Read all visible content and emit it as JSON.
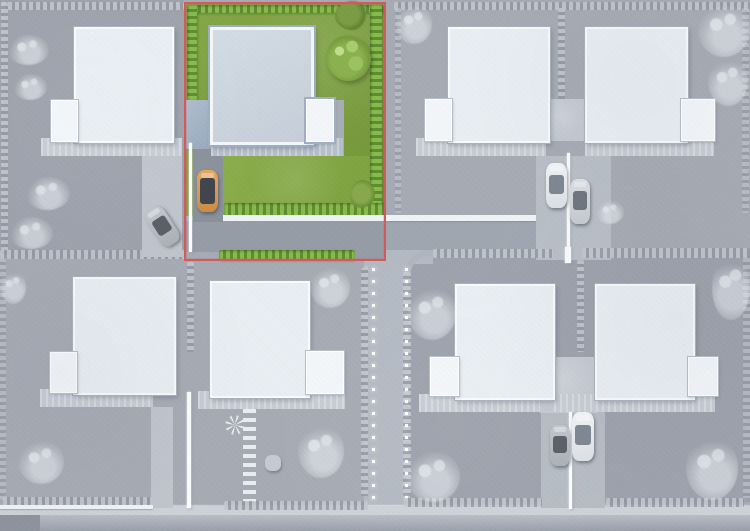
{
  "scene": {
    "type": "aerial-site-plan",
    "description": "Top-down rendering of a residential development; one plot is highlighted in full color with a red outline while the rest of the scene is desaturated gray",
    "selected_plot": {
      "position": "top-center-left",
      "outline_color": "#d05a5e",
      "features": [
        "house with blue-gray flat roof",
        "white garden-room extension",
        "carport",
        "dark driveway",
        "orange car",
        "lawn",
        "green hedges",
        "two trees",
        "bush"
      ]
    },
    "plots_total": 8,
    "houses_total": 8,
    "cars": [
      {
        "location": "selected-plot-driveway",
        "color": "orange"
      },
      {
        "location": "top-left-driveway",
        "color": "gray",
        "angle": "diagonal"
      },
      {
        "location": "top-right-shared-driveway",
        "color": "white"
      },
      {
        "location": "top-right-shared-driveway",
        "color": "silver"
      },
      {
        "location": "bottom-right-shared-driveway",
        "color": "gray"
      },
      {
        "location": "bottom-right-shared-driveway",
        "color": "white"
      }
    ],
    "roads": [
      "east-west access road below selected plot",
      "central vertical road with light studs",
      "bottom road with sidewalk"
    ],
    "street_lights": "white stud lights lining both sides of the central road"
  },
  "palette": {
    "accent": "#d05a5e",
    "base": "#a6abb4",
    "lawn": "#7fa03f",
    "lawnLight": "#93b254",
    "hedgeGreenA": "#86bb4d",
    "hedgeGreenB": "#5f8c31",
    "roofBlue": "#ccd4dd",
    "roofWhite": "#e9eef3",
    "carport": "#a2b2c4",
    "roadMain": "#969da7",
    "roadLight": "#b4bac3",
    "sidewalk": "#cdd2d9",
    "curb": "#f0f3f6",
    "carOrange": "#dc9b51",
    "glass": "#4d525b"
  }
}
